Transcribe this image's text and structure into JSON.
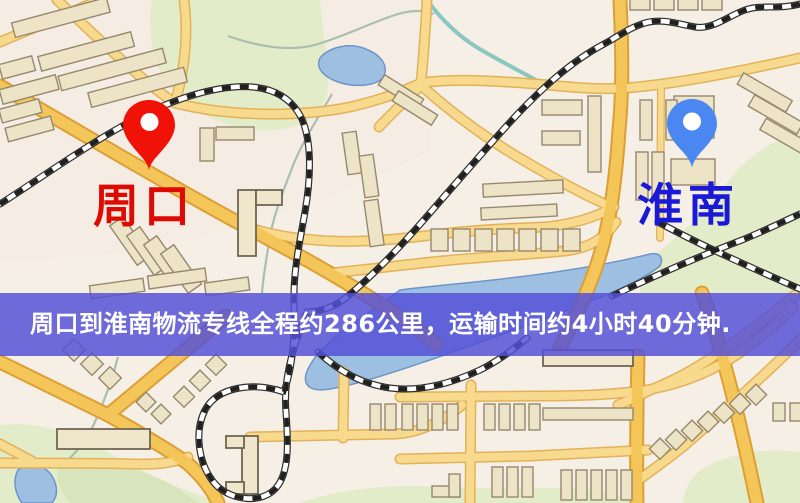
{
  "map": {
    "origin": {
      "name": "周口"
    },
    "destination": {
      "name": "淮南"
    },
    "banner": {
      "text": "周口到淮南物流专线全程约286公里，运输时间约4小时40分钟."
    },
    "colors": {
      "background": "#f5efe5",
      "park_green": "#e3ecc9",
      "water_blue": "#8fb6dd",
      "road_yellow": "#f4c65a",
      "railway_black": "#2e2e2e",
      "origin_pin": "#f01206",
      "origin_label": "#dd0b02",
      "destination_pin": "#4a87f0",
      "destination_label": "#1a1ad6",
      "banner_overlay": "#5350d6",
      "banner_text": "#ffffff"
    }
  }
}
